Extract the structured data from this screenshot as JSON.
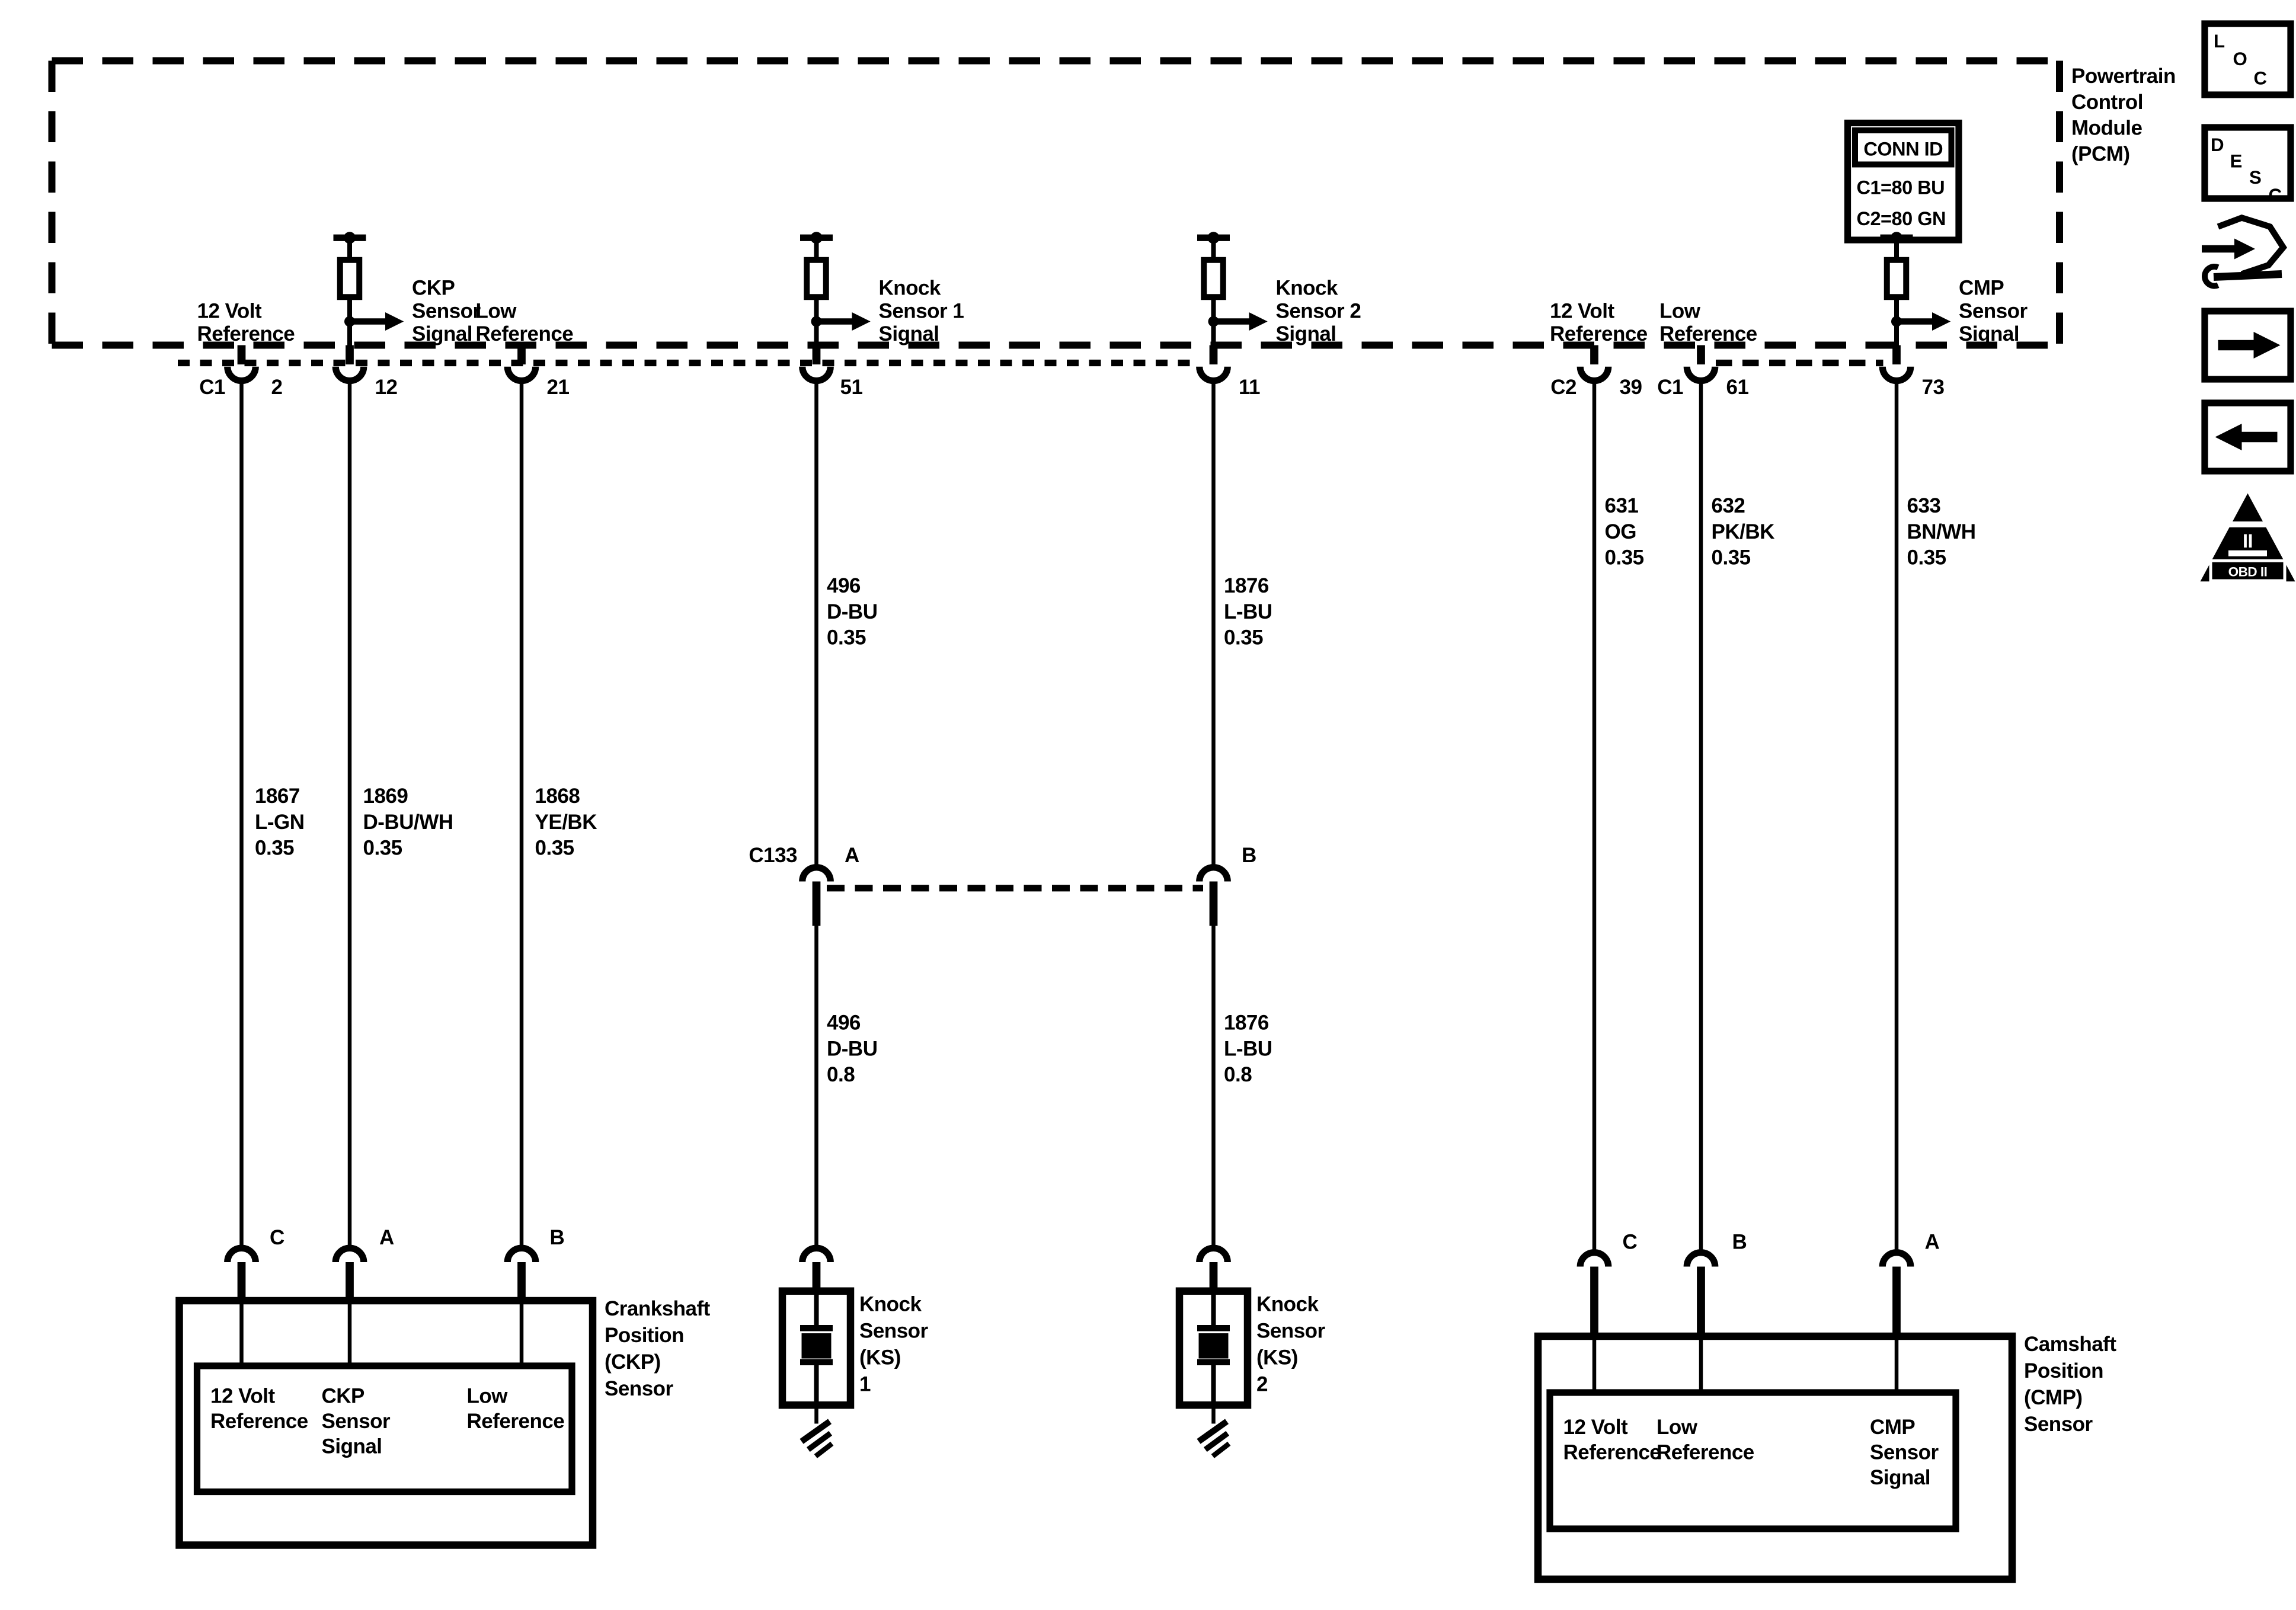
{
  "pcm": {
    "name_lines": [
      "Powertrain",
      "Control",
      "Module",
      "(PCM)"
    ],
    "conn_id": {
      "title": "CONN ID",
      "rows": [
        "C1=80 BU",
        "C2=80 GN"
      ]
    },
    "ref_labels": {
      "v12_left": [
        "12 Volt",
        "Reference"
      ],
      "low_left": [
        "Low",
        "Reference"
      ],
      "v12_right": [
        "12 Volt",
        "Reference"
      ],
      "low_right": [
        "Low",
        "Reference"
      ]
    },
    "signal_labels": {
      "ckp": [
        "CKP",
        "Sensor",
        "Signal"
      ],
      "ks1": [
        "Knock",
        "Sensor 1",
        "Signal"
      ],
      "ks2": [
        "Knock",
        "Sensor 2",
        "Signal"
      ],
      "cmp": [
        "CMP",
        "Sensor",
        "Signal"
      ]
    },
    "terminals": {
      "conn_c1_left": "C1",
      "pin2": "2",
      "pin12": "12",
      "pin21": "21",
      "pin51": "51",
      "pin11": "11",
      "conn_c2": "C2",
      "pin39": "39",
      "conn_c1_right": "C1",
      "pin61": "61",
      "pin73": "73"
    }
  },
  "wires": {
    "w1867": [
      "1867",
      "L-GN",
      "0.35"
    ],
    "w1869": [
      "1869",
      "D-BU/WH",
      "0.35"
    ],
    "w1868": [
      "1868",
      "YE/BK",
      "0.35"
    ],
    "w496_035": [
      "496",
      "D-BU",
      "0.35"
    ],
    "w1876_035": [
      "1876",
      "L-BU",
      "0.35"
    ],
    "w496_08": [
      "496",
      "D-BU",
      "0.8"
    ],
    "w1876_08": [
      "1876",
      "L-BU",
      "0.8"
    ],
    "w631": [
      "631",
      "OG",
      "0.35"
    ],
    "w632": [
      "632",
      "PK/BK",
      "0.35"
    ],
    "w633": [
      "633",
      "BN/WH",
      "0.35"
    ]
  },
  "c133": {
    "name": "C133",
    "pin_a": "A",
    "pin_b": "B"
  },
  "sensors": {
    "ckp": {
      "pins": [
        "C",
        "A",
        "B"
      ],
      "inner_labels": {
        "v12": [
          "12 Volt",
          "Reference"
        ],
        "sig": [
          "CKP",
          "Sensor",
          "Signal"
        ],
        "low": [
          "Low",
          "Reference"
        ]
      },
      "side_label": [
        "Crankshaft",
        "Position",
        "(CKP)",
        "Sensor"
      ]
    },
    "ks1": {
      "label": [
        "Knock",
        "Sensor",
        "(KS)",
        "1"
      ]
    },
    "ks2": {
      "label": [
        "Knock",
        "Sensor",
        "(KS)",
        "2"
      ]
    },
    "cmp": {
      "pins": [
        "C",
        "B",
        "A"
      ],
      "inner_labels": {
        "v12": [
          "12 Volt",
          "Reference"
        ],
        "low": [
          "Low",
          "Reference"
        ],
        "sig": [
          "CMP",
          "Sensor",
          "Signal"
        ]
      },
      "side_label": [
        "Camshaft",
        "Position",
        "(CMP)",
        "Sensor"
      ]
    }
  },
  "legend": {
    "loc": [
      "L",
      "O",
      "C"
    ],
    "desc": [
      "D",
      "E",
      "S",
      "C"
    ],
    "obd_numeral": "II",
    "obd_label": "OBD II"
  },
  "colors": {
    "ink": "#000000",
    "paper": "#ffffff"
  }
}
